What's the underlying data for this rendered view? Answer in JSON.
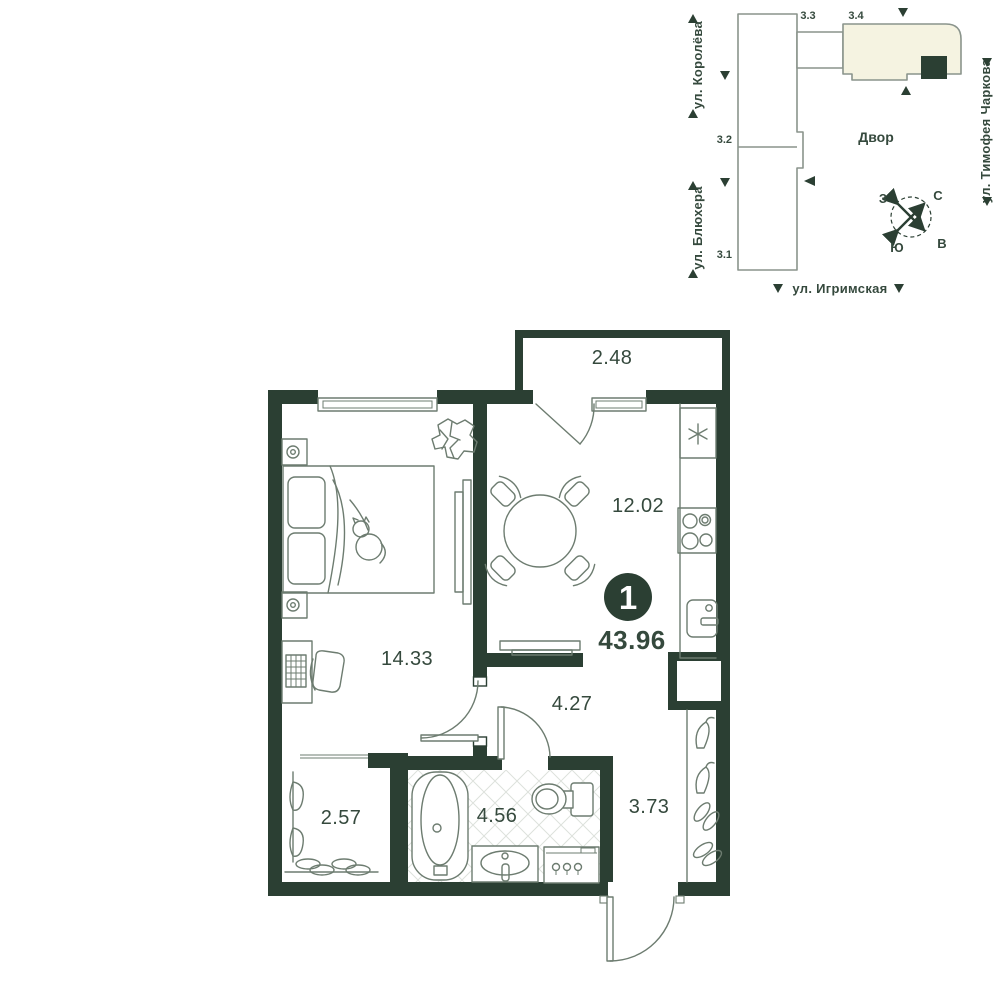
{
  "site_plan": {
    "streets": {
      "koroleva": "ул. Королёва",
      "blyukhera": "ул. Блюхера",
      "timofeya_charkova": "ул. Тимофея Чаркова",
      "igrimskaya": "ул. Игримская"
    },
    "buildings": {
      "b31": "3.1",
      "b32": "3.2",
      "b33": "3.3",
      "b34": "3.4"
    },
    "courtyard_label": "Двор",
    "compass": {
      "north": "С",
      "south": "Ю",
      "west": "З",
      "east": "В"
    }
  },
  "floor_plan": {
    "apartment": {
      "rooms_badge": "1",
      "total_area": "43.96"
    },
    "rooms": {
      "balcony": {
        "area": "2.48"
      },
      "kitchen_living": {
        "area": "12.02"
      },
      "bedroom": {
        "area": "14.33"
      },
      "hall": {
        "area": "4.27"
      },
      "wardrobe": {
        "area": "2.57"
      },
      "bathroom": {
        "area": "4.56"
      },
      "hallway": {
        "area": "3.73"
      }
    }
  },
  "colors": {
    "wall": "#2b3f33",
    "label": "#35493d",
    "outline": "#8a948c",
    "furniture": "#6d7c70",
    "cream": "#f5f3e1",
    "tile": "#dde1dc",
    "white": "#ffffff"
  }
}
